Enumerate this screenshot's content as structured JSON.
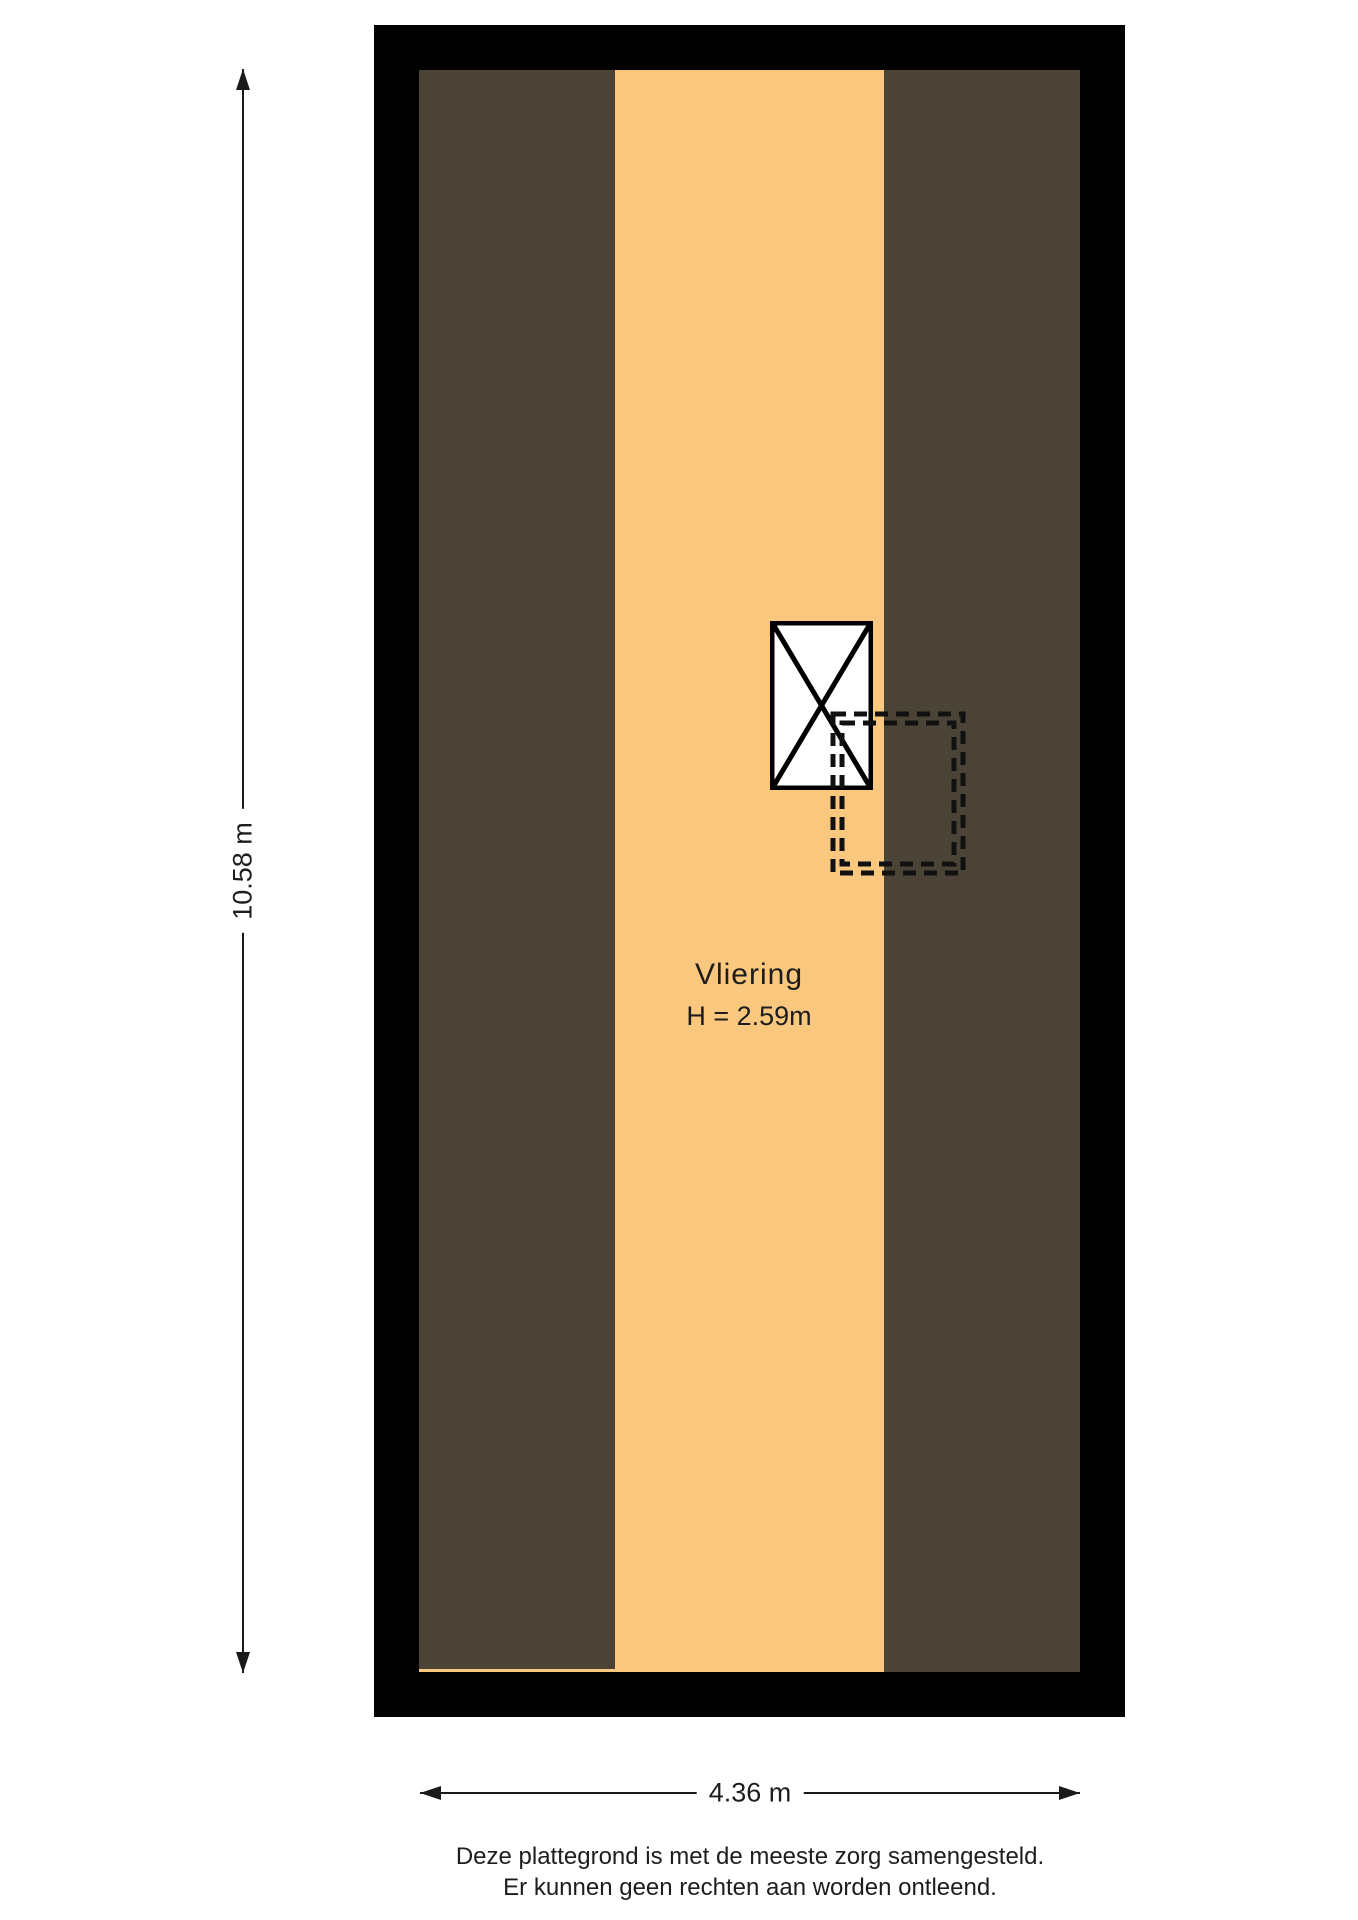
{
  "plan": {
    "room": {
      "name": "Vliering",
      "height_label": "H = 2.59m"
    }
  },
  "dimensions": {
    "vertical_label": "10.58 m",
    "horizontal_label": "4.36 m"
  },
  "disclaimer": {
    "line1": "Deze plattegrond is met de meeste zorg samengesteld.",
    "line2": "Er kunnen geen rechten aan worden ontleend."
  },
  "colors": {
    "wall": "#000000",
    "floor": "#FAC77E",
    "slope": "#4B4336",
    "text": "#1D1D1D",
    "line": "#1A1A1A"
  },
  "icons": {
    "stairs_cross": "stairs-cross-icon (X over rectangle = staircase symbol)",
    "stair_opening": "dashed double rectangle = stair opening / void",
    "dimension_arrows": [
      "arrow-up-icon",
      "arrow-down-icon",
      "arrow-left-icon",
      "arrow-right-icon"
    ]
  }
}
